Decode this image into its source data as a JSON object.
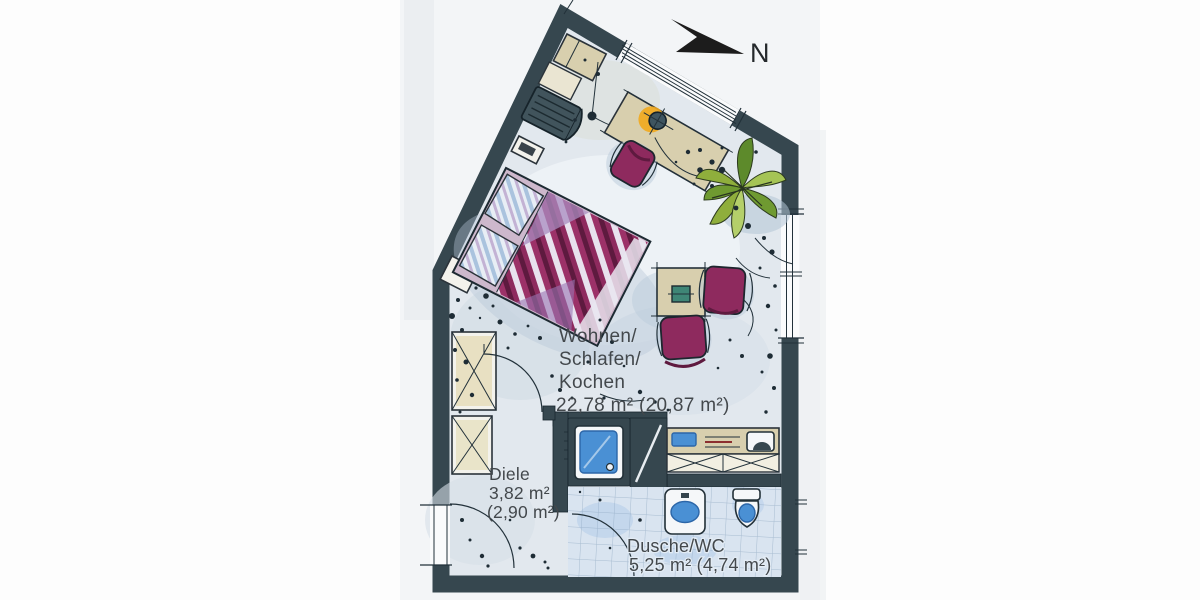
{
  "compass": {
    "label": "N"
  },
  "rooms": {
    "living": {
      "line1": "Wohnen/",
      "line2": "Schlafen/",
      "line3": "Kochen",
      "area": "22,78 m² (20,87 m²)"
    },
    "hall": {
      "name": "Diele",
      "area": "3,82 m²",
      "area_paren": "(2,90 m²)"
    },
    "bath": {
      "name": "Dusche/WC",
      "area": "5,25 m² (4,74 m²)"
    }
  },
  "colors": {
    "wall": "#36474f",
    "floor": "#e2e8ee",
    "tile": "#d9e4f0",
    "accent_magenta": "#8e2a5e",
    "accent_violet": "#a487b8",
    "wood": "#d8cfae",
    "water_blue": "#4a90d4",
    "plant_green": "#79a238",
    "lamp_yellow": "#f2a81d",
    "ink": "#22313a",
    "text": "#43484c"
  }
}
